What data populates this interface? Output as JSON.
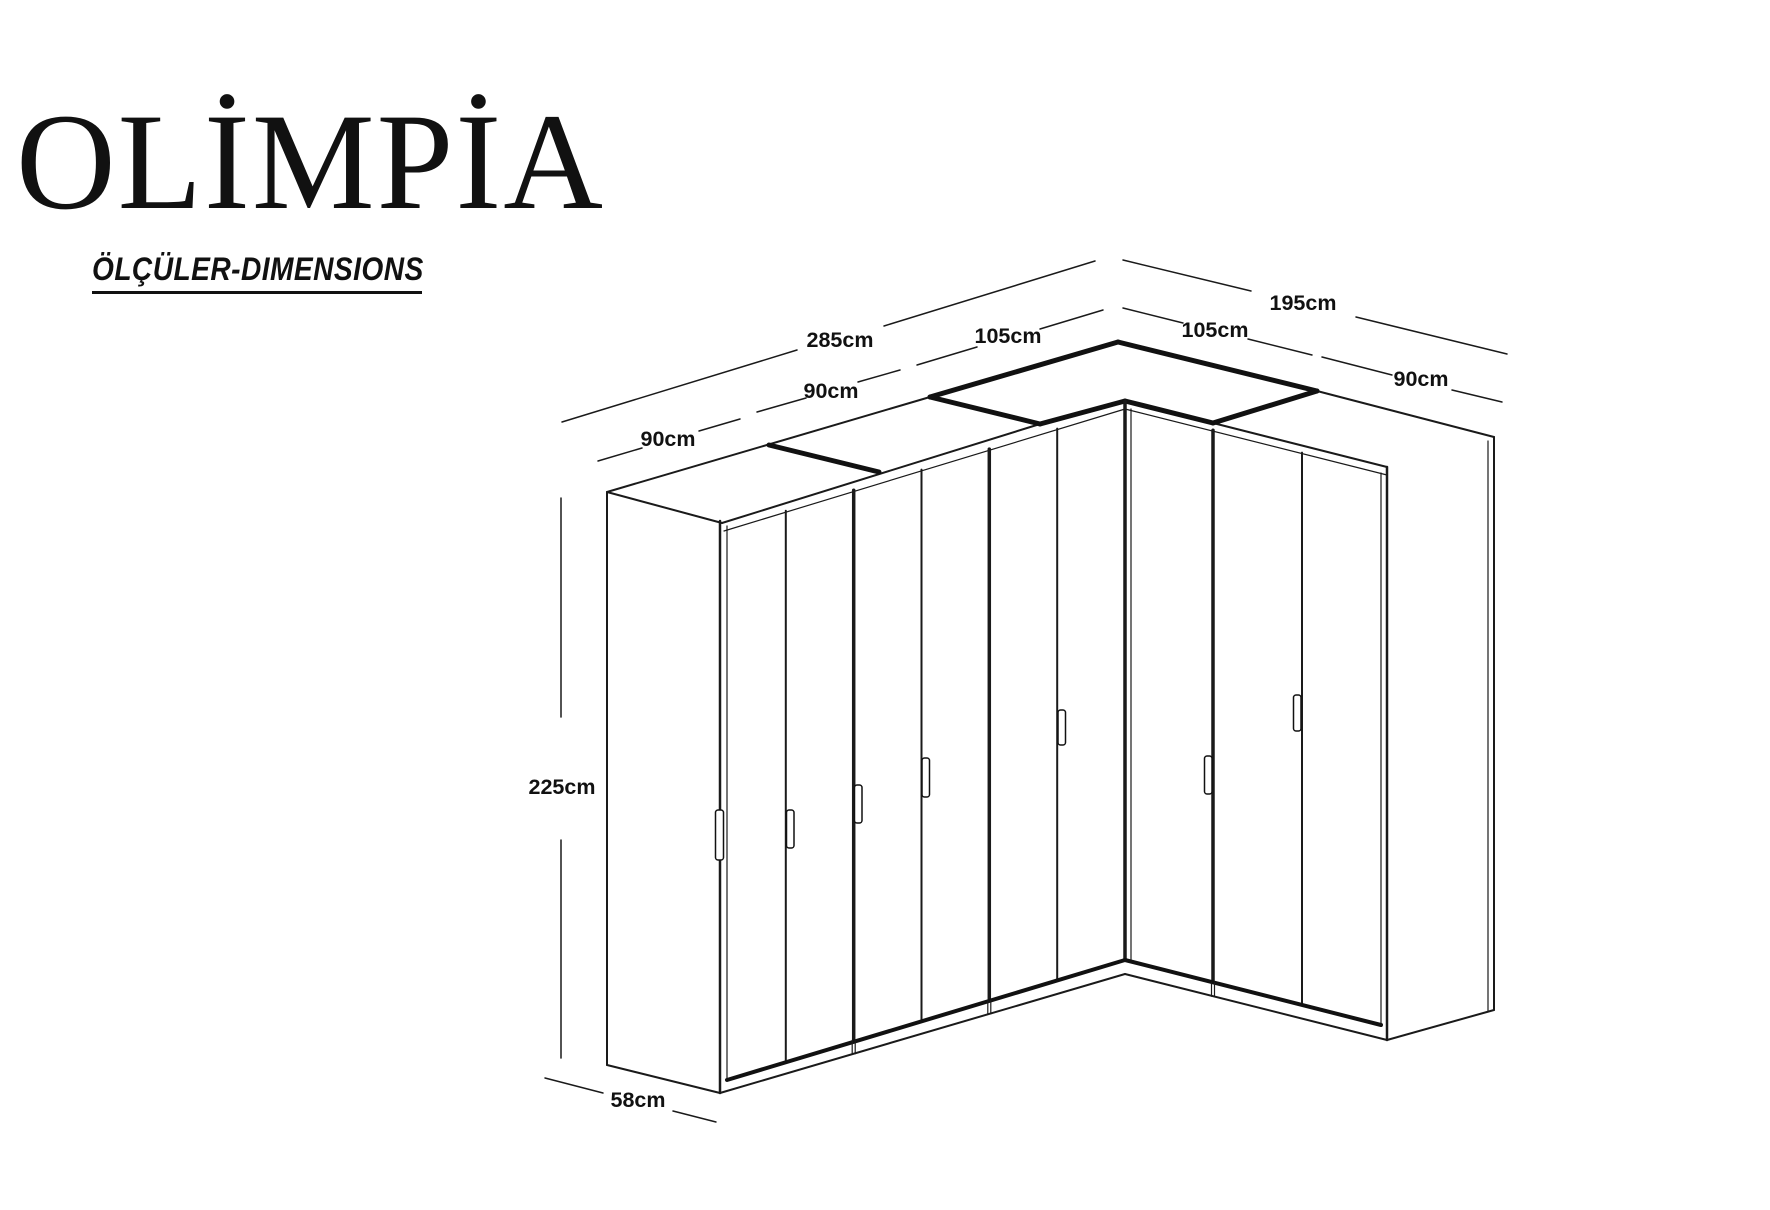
{
  "brand": {
    "title": "OLİMPİA",
    "subtitle": "ÖLÇÜLER-DIMENSIONS"
  },
  "diagram": {
    "line_color": "#1a1a1a",
    "labels": {
      "left_total": "285cm",
      "left_module_1": "90cm",
      "left_module_2": "90cm",
      "left_corner_module": "105cm",
      "right_corner_module": "105cm",
      "right_total": "195cm",
      "right_module": "90cm",
      "height": "225cm",
      "depth": "58cm"
    }
  }
}
